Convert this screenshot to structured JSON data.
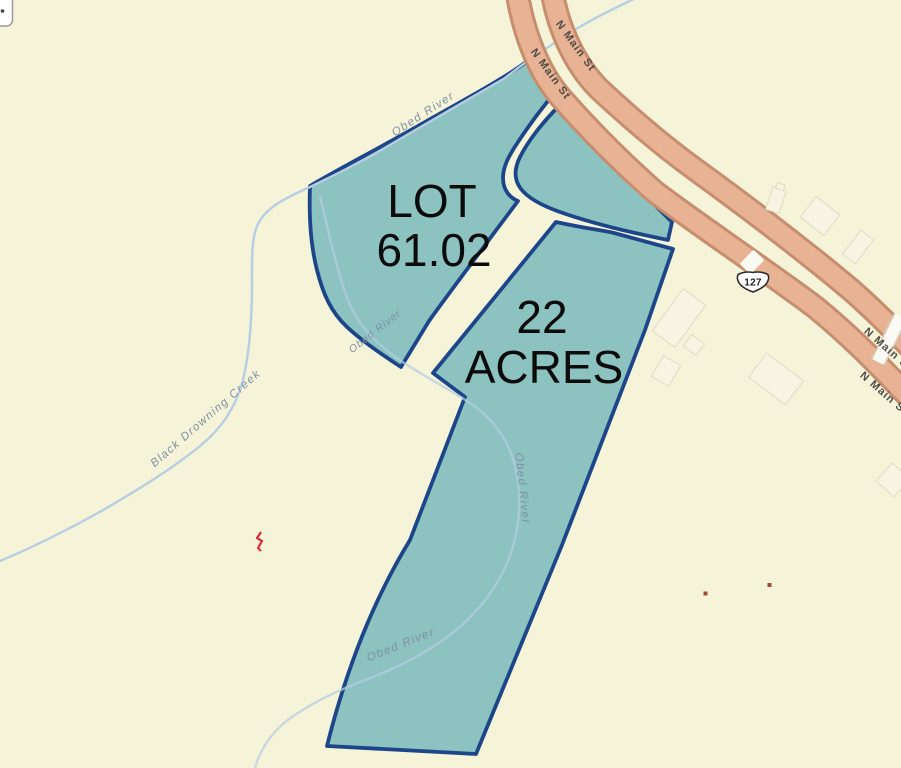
{
  "parcel": {
    "lot_line1": "LOT",
    "lot_line2": "61.02",
    "area_line1": "22",
    "area_line2": "ACRES"
  },
  "roads": {
    "street_name": "N Main St",
    "route_shield": "127"
  },
  "water": {
    "river_name": "Obed River",
    "creek_name": "Black Drowning Creek"
  },
  "colors": {
    "background": "#f5f4d8",
    "parcel_fill": "#8cc2c0",
    "parcel_border": "#1c4689",
    "road_fill": "#e7b394",
    "road_casing": "#c68d6e",
    "water_line": "#b7cde2",
    "label_black": "#0b0b0b",
    "road_label": "#4f4b46",
    "water_label": "#7f91a4",
    "marker_red": "#e02c3c",
    "building_dot": "#a04a38"
  }
}
